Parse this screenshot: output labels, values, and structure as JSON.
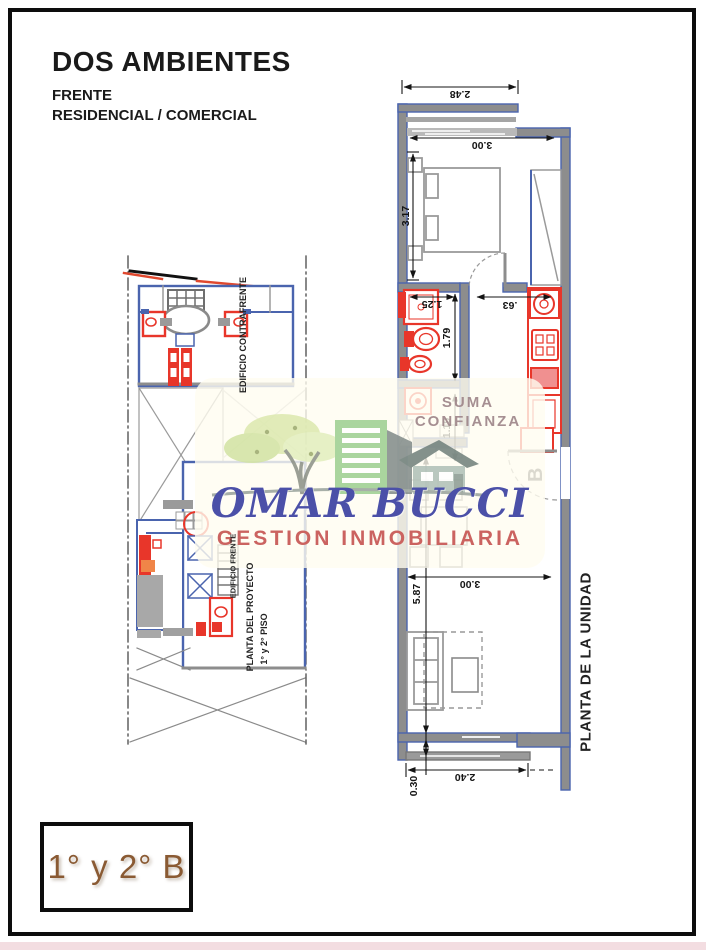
{
  "header": {
    "title": "DOS AMBIENTES",
    "subtitle1": "FRENTE",
    "subtitle2": "RESIDENCIAL / COMERCIAL"
  },
  "unit_badge": {
    "label": "1° y 2° B"
  },
  "watermark": {
    "tagline1": "SUMA",
    "tagline2": "CONFIANZA",
    "brand": "OMAR BUCCI",
    "brand_sub": "GESTION INMOBILIARIA"
  },
  "project_plan": {
    "caption_contrafrente": "EDIFICIO CONTRAFRENTE",
    "caption_frente": "EDIFICIO FRENTE",
    "caption_line1": "PLANTA DEL PROYECTO",
    "caption_line2": "1° y 2° PISO"
  },
  "unit_plan": {
    "caption": "PLANTA DE LA UNIDAD",
    "door_label": "B",
    "dims": {
      "front_width": "2.48",
      "bedroom_width": "3.00",
      "bedroom_depth": "3.17",
      "bathroom_width": "1.25",
      "kitchen_passage": ".63",
      "bathroom_depth": "1.79",
      "hall_depth": "1.19",
      "living_depth": "5.87",
      "living_width": "3.00",
      "balcony_width": "2.40",
      "balcony_depth": "0.30"
    }
  },
  "colors": {
    "wall_blue": "#4a64ae",
    "wall_gray": "#8d8d8d",
    "fixture_red": "#e8362a",
    "roof_orange": "#e0482e",
    "dim_black": "#141414",
    "brand_blue": "#4b50a8",
    "brand_red": "#cb6360",
    "tagline_mauve": "#9d8488",
    "badge_brown": "#8a5a33",
    "bottom_strip_pink": "#f3dde1"
  }
}
